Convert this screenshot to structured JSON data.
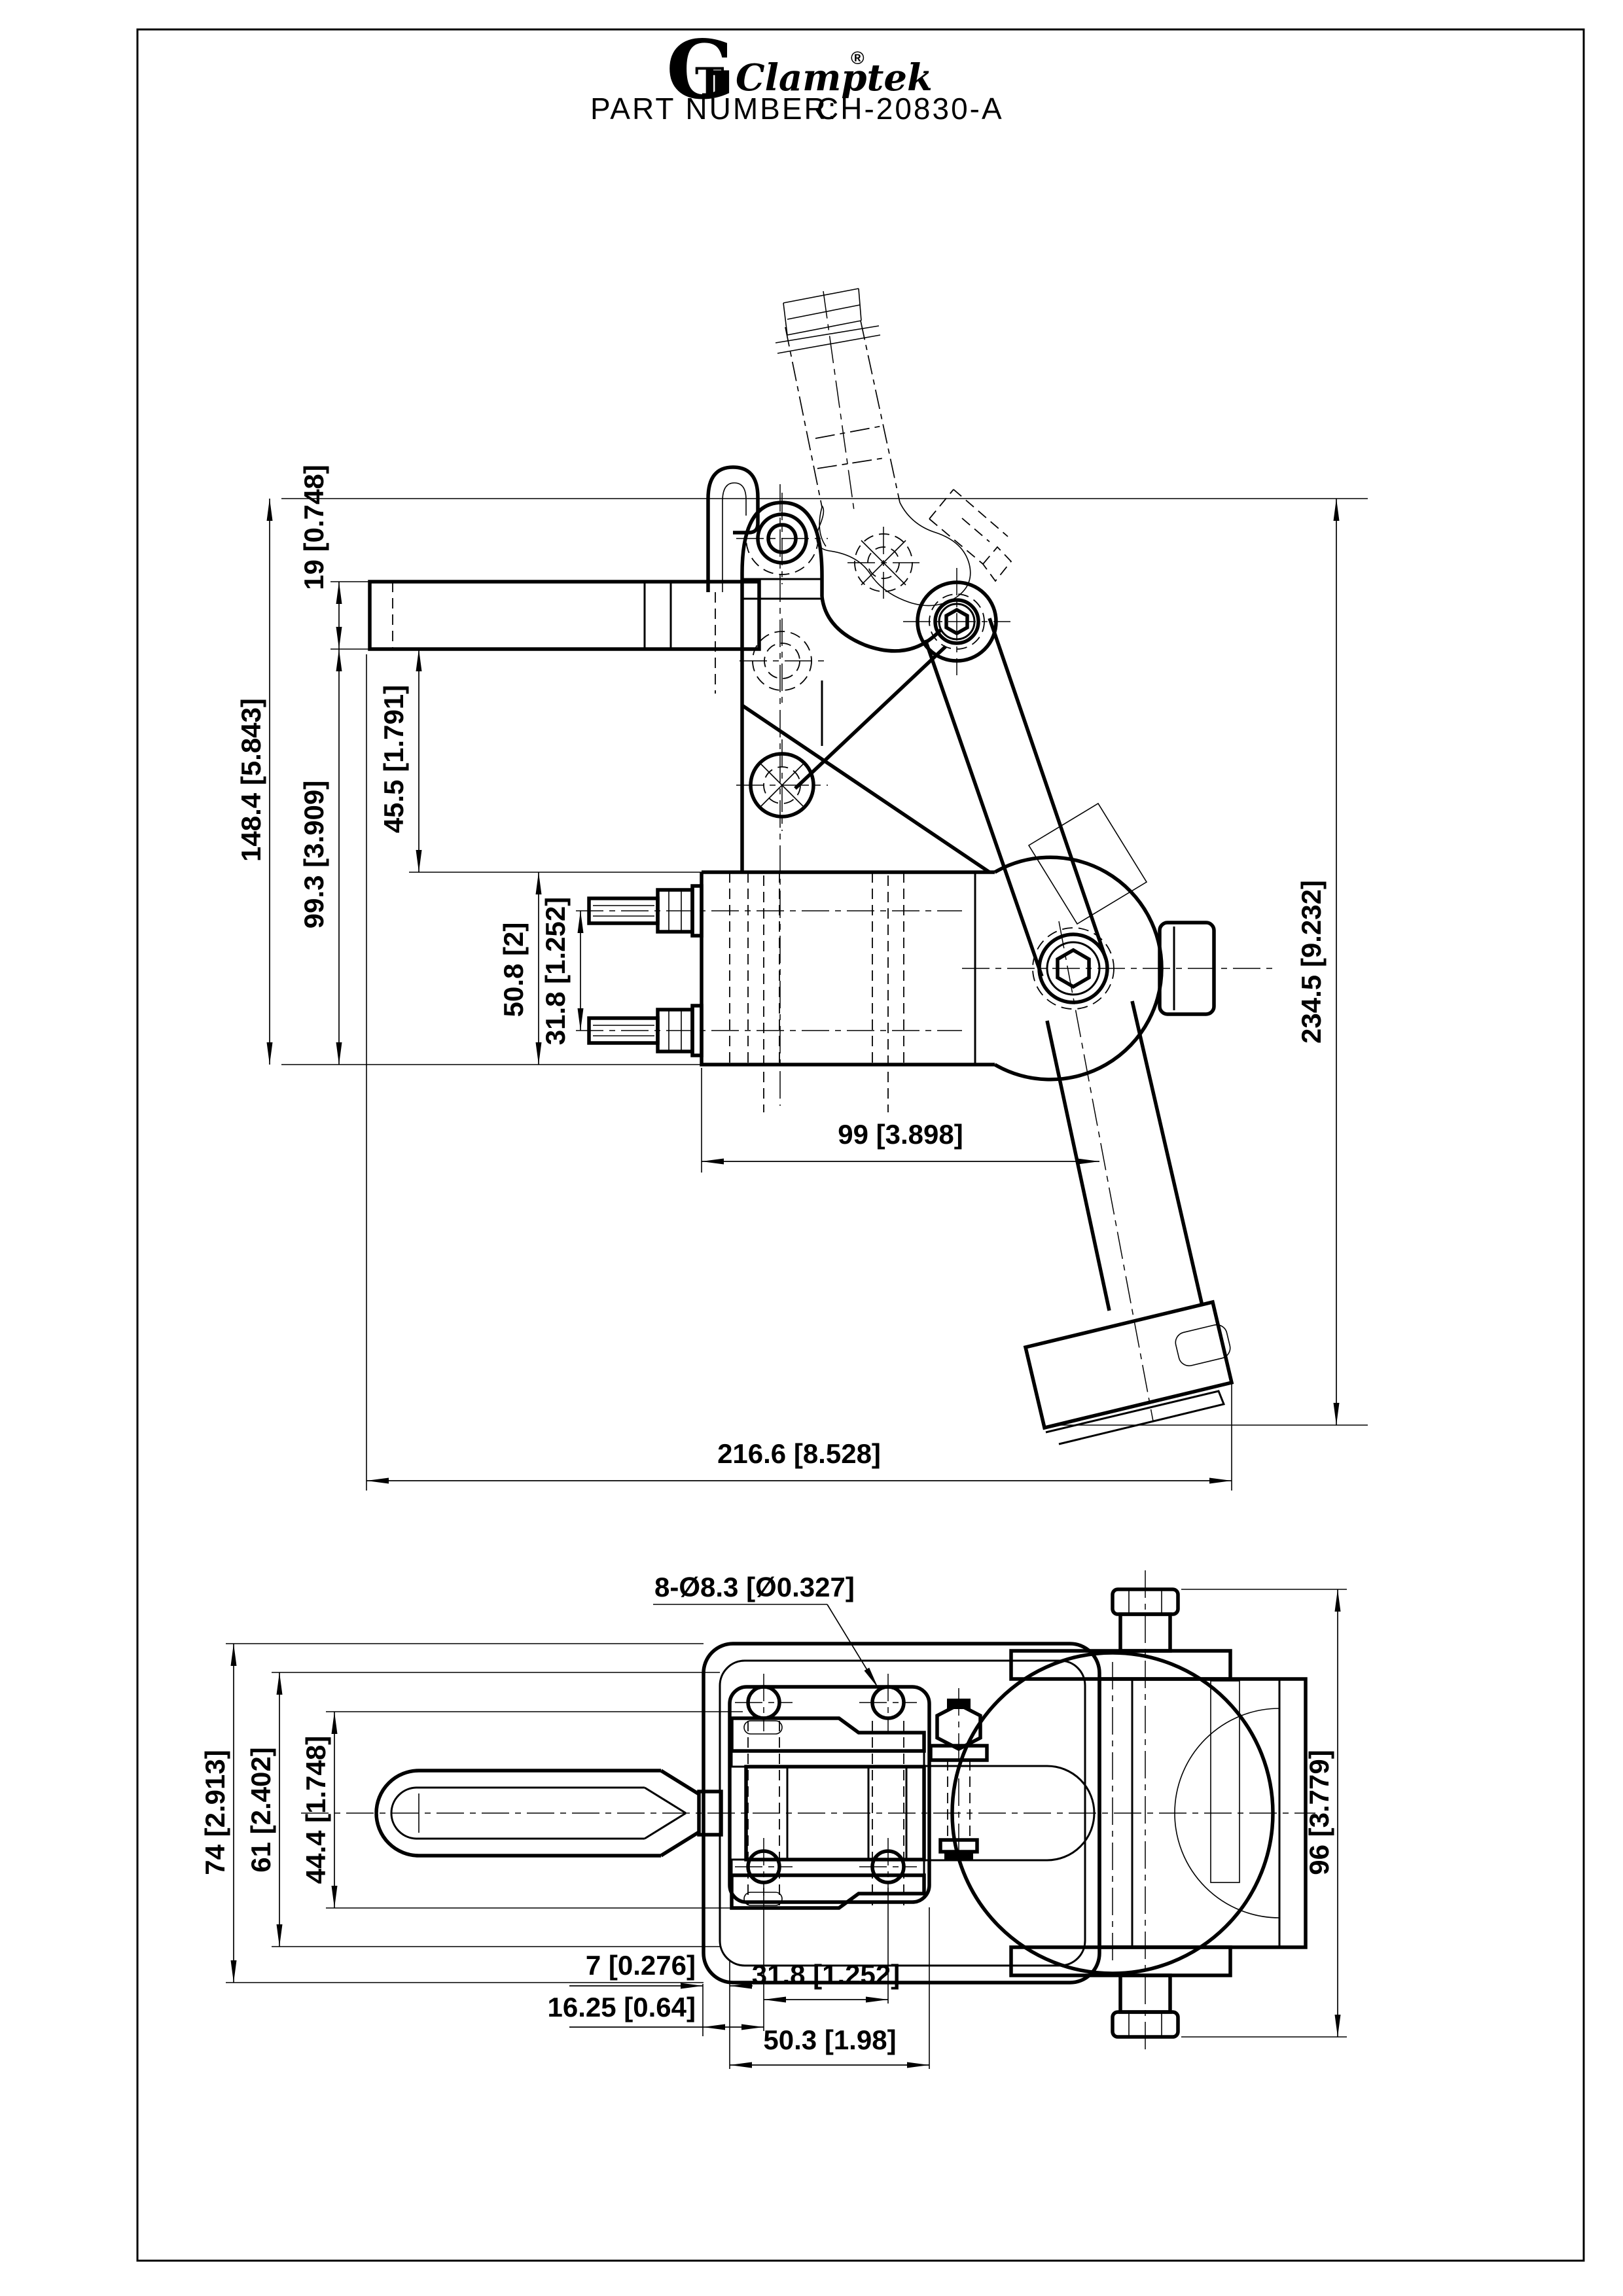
{
  "sheet": {
    "background": "#ffffff",
    "line_color": "#000000"
  },
  "header": {
    "logo_g": "G",
    "logo_t": "T",
    "logo_name": "Clamptek",
    "logo_registered": "®",
    "part_number_label": "PART NUMBER:",
    "part_number_value": "CH-20830-A"
  },
  "side_view": {
    "dims": {
      "overall_height": "148.4 [5.843]",
      "arm_thickness": "19 [0.748]",
      "arm_to_base_bottom": "99.3 [3.909]",
      "arm_to_base_top": "45.5 [1.791]",
      "base_height": "50.8 [2]",
      "bolt_spacing": "31.8 [1.252]",
      "base_to_pivot": "99 [3.898]",
      "overall_length": "216.6 [8.528]",
      "open_height": "234.5 [9.232]"
    }
  },
  "plan_view": {
    "dims": {
      "base_width": "74 [2.913]",
      "inner_width": "61 [2.402]",
      "slot_width": "44.4 [1.748]",
      "roller_width": "96 [3.779]",
      "edge_to_boss": "7 [0.276]",
      "edge_to_hole": "16.25 [0.64]",
      "hole_spacing": "31.8 [1.252]",
      "hole_span": "50.3 [1.98]",
      "holes_note": "8-Ø8.3 [Ø0.327]"
    }
  }
}
